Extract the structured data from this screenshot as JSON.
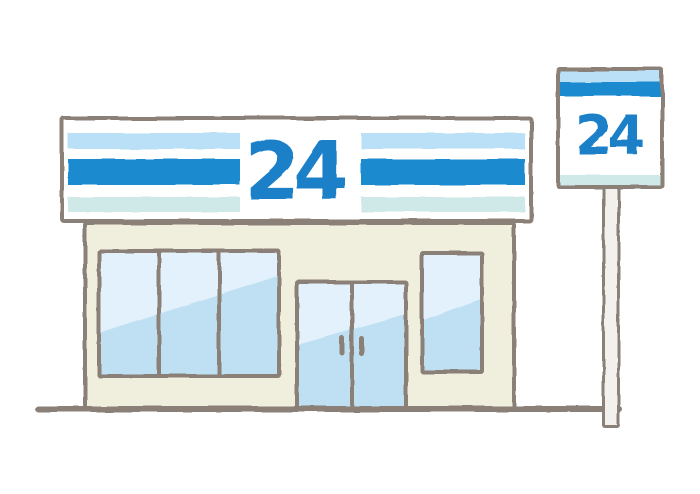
{
  "illustration": {
    "storefront_sign": {
      "number": "24"
    },
    "pole_sign": {
      "number": "24"
    },
    "colors": {
      "stripe_light_blue": "#b9e0f6",
      "stripe_blue": "#1b8ace",
      "stripe_pale_cyan": "#cfe9e9",
      "number_blue": "#1a80c8",
      "outline_gray": "#8b8077",
      "wall_cream": "#f0eedd",
      "glass_blue": "#bfe0f2",
      "glass_highlight": "#e2f1fb",
      "pole_white": "#f2f1ed",
      "background": "#ffffff"
    }
  }
}
